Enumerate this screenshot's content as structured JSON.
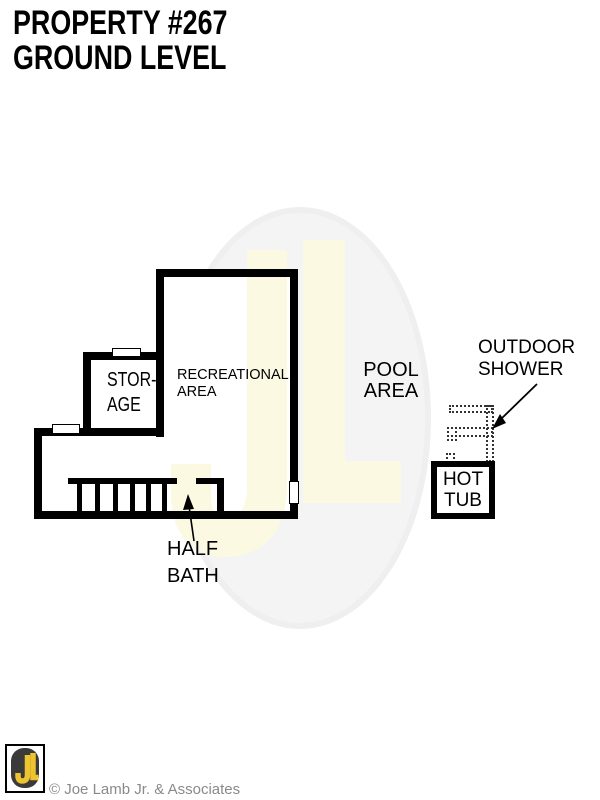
{
  "title": {
    "line1": "PROPERTY #267",
    "line2": "GROUND LEVEL"
  },
  "plan": {
    "storage": {
      "line1": "STOR-",
      "line2": "AGE"
    },
    "recreational": {
      "line1": "RECREATIONAL",
      "line2": "AREA"
    },
    "pool": {
      "line1": "POOL",
      "line2": "AREA"
    },
    "outdoor_shower": {
      "line1": "OUTDOOR",
      "line2": "SHOWER"
    },
    "hot_tub": {
      "line1": "HOT",
      "line2": "TUB"
    },
    "half_bath": {
      "line1": "HALF",
      "line2": "BATH"
    }
  },
  "watermark": {
    "letters": "JL",
    "ellipse_color": "#f4f4f4",
    "ellipse_edge_color": "#efefef",
    "letter_color": "#fcf9e3"
  },
  "footer": {
    "logo_letters": "JL",
    "logo_letter_color": "#edc32f",
    "logo_bg_color": "#3a3a3a",
    "copyright": "© Joe Lamb Jr. & Associates",
    "copyright_color": "#8a8a8a"
  },
  "colors": {
    "wall": "#000000",
    "background": "#ffffff",
    "arrow": "#000000"
  }
}
